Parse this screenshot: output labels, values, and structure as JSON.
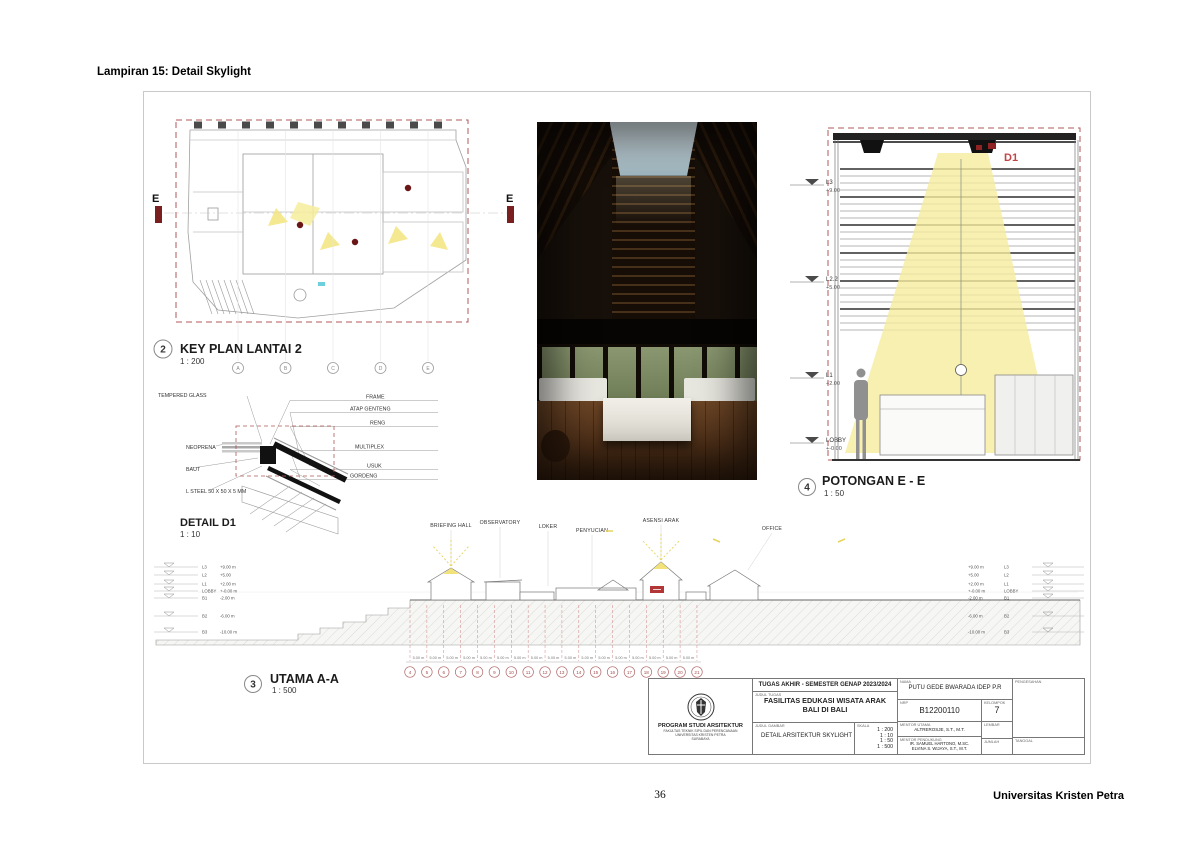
{
  "page": {
    "header": "Lampiran 15: Detail Skylight",
    "page_number": "36",
    "footer_right": "Universitas Kristen Petra"
  },
  "keyplan": {
    "number": "2",
    "title": "KEY PLAN LANTAI 2",
    "scale": "1 : 200",
    "section_marker_left": "E",
    "section_marker_right": "E",
    "grid_bubbles": [
      "A",
      "B",
      "C",
      "D",
      "E"
    ]
  },
  "detail": {
    "title": "DETAIL D1",
    "scale": "1 : 10",
    "labels_left": [
      "TEMPERED GLASS",
      "NEOPRENA",
      "BAUT",
      "L STEEL 50 X 50 X 5 MM"
    ],
    "labels_right": [
      "FRAME",
      "ATAP GENTENG",
      "RENG",
      "MULTIPLEX",
      "USUK",
      "GORDENG"
    ]
  },
  "potongan": {
    "number": "4",
    "title": "POTONGAN E - E",
    "scale": "1 : 50",
    "detail_ref": "D1",
    "levels": [
      {
        "name": "L3",
        "elev": "+9.00"
      },
      {
        "name": "L2.2",
        "elev": "+5.00"
      },
      {
        "name": "L1",
        "elev": "+2.00"
      },
      {
        "name": "LOBBY",
        "elev": "+-0.00"
      }
    ]
  },
  "utama": {
    "number": "3",
    "title": "UTAMA A-A",
    "scale": "1 : 500",
    "room_labels": [
      "BRIEFING HALL",
      "OBSERVATORY",
      "LOKER",
      "PENYUCIAN",
      "ASENSI ARAK",
      "OFFICE"
    ],
    "levels": [
      {
        "name": "L3",
        "elev": "+9.00 m"
      },
      {
        "name": "L2",
        "elev": "+5.00"
      },
      {
        "name": "L1",
        "elev": "+2.00 m"
      },
      {
        "name": "LOBBY",
        "elev": "+-0.00 m"
      },
      {
        "name": "B1",
        "elev": "-2.00 m"
      },
      {
        "name": "B2",
        "elev": "-6.00 m"
      },
      {
        "name": "B3",
        "elev": "-10.00 m"
      }
    ],
    "grid_bubbles": [
      "4",
      "5",
      "6",
      "7",
      "8",
      "9",
      "10",
      "11",
      "12",
      "13",
      "14",
      "15",
      "16",
      "17",
      "18",
      "19",
      "20",
      "21"
    ],
    "dim_label": "5.00 m"
  },
  "titleblock": {
    "course": "TUGAS AKHIR - SEMESTER GENAP 2023/2024",
    "labels": {
      "judul_tugas": "JUDUL TUGAS",
      "judul_gambar": "JUDUL GAMBAR",
      "skala": "SKALA",
      "nama": "NAMA",
      "nrp": "NRP",
      "kelompok": "KELOMPOK",
      "mentor_utama": "MENTOR UTAMA",
      "mentor_pendukung": "MENTOR PENDUKUNG",
      "lembar": "LEMBAR",
      "jumlah": "JUMLAH",
      "pengesahan": "PENGESAHAN",
      "tanggal": "TANGGAL"
    },
    "judul_tugas_value_1": "FASILITAS EDUKASI WISATA ARAK",
    "judul_tugas_value_2": "BALI DI BALI",
    "judul_gambar_value": "DETAIL ARSITEKTUR SKYLIGHT",
    "skala_values": [
      "1 : 200",
      "1 : 10",
      "1 : 50",
      "1 : 500"
    ],
    "nama_value": "PUTU GEDE BWARADA IDEP P.R",
    "nrp_value": "B12200110",
    "kelompok_value": "7",
    "mentor_utama_value": "ALTREROSJE, S.T., M.T.",
    "mentor_pendukung_value_1": "IR. SAMUEL HARTONO, M.SC.",
    "mentor_pendukung_value_2": "ELVINA S. WIJAYA, S.T., M.T.",
    "institution": [
      "PROGRAM STUDI ARSITEKTUR",
      "FAKULTAS TEKNIK SIPIL DAN PERENCANAAN",
      "UNIVERSITAS KRISTEN PETRA",
      "SURABAYA"
    ]
  },
  "colors": {
    "accent_red": "#a04848",
    "marker_maroon": "#6b1616",
    "light_yellow": "#f6ec9e"
  }
}
